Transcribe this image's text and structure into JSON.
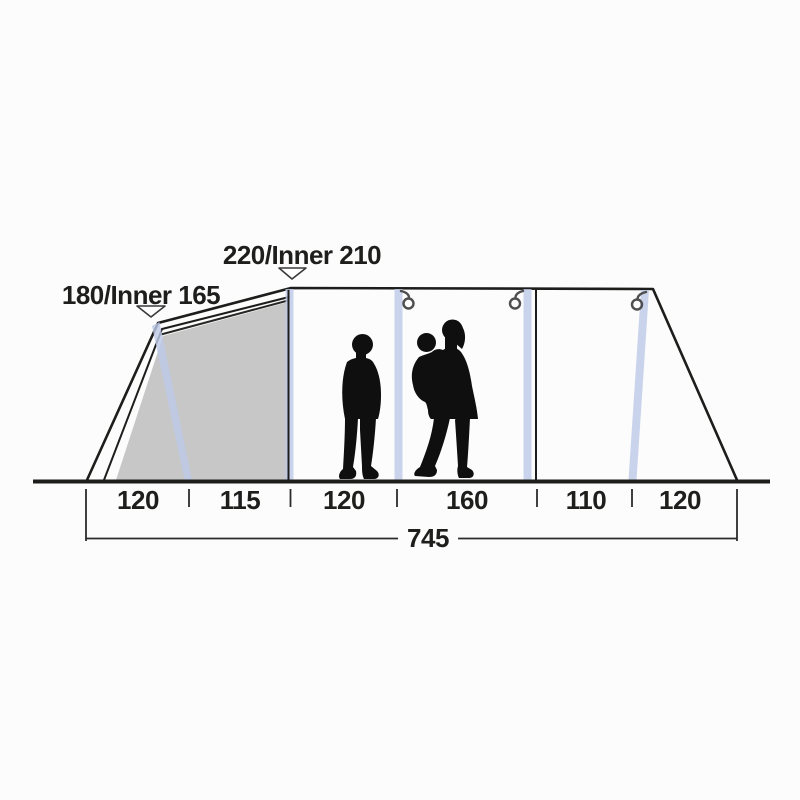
{
  "diagram": {
    "height_labels": [
      {
        "text": "180/Inner 165"
      },
      {
        "text": "220/Inner 210"
      }
    ],
    "width_segments": [
      {
        "text": "120"
      },
      {
        "text": "115"
      },
      {
        "text": "120"
      },
      {
        "text": "160"
      },
      {
        "text": "110"
      },
      {
        "text": "120"
      }
    ],
    "total_width": {
      "text": "745"
    },
    "measurements": {
      "segments_cm": [
        120,
        115,
        120,
        160,
        110,
        120
      ],
      "total_cm": 745,
      "front_height_cm": {
        "outer": 180,
        "inner": 165
      },
      "main_height_cm": {
        "outer": 220,
        "inner": 210
      }
    },
    "icons": {
      "hanging_points": [
        "lantern-hook-icon",
        "lantern-hook-icon",
        "lantern-hook-icon"
      ],
      "height_markers": [
        "triangle-down-marker",
        "triangle-down-marker"
      ]
    },
    "colors": {
      "line": "#1d1d1b",
      "inner_tent_fill": "#c7c7c7",
      "air_pole": "#bdc9e7",
      "hook": "#4e4e4e",
      "silhouette": "#0f0f0f",
      "background": "#fcfcfc",
      "text": "#1e1e1c"
    }
  }
}
